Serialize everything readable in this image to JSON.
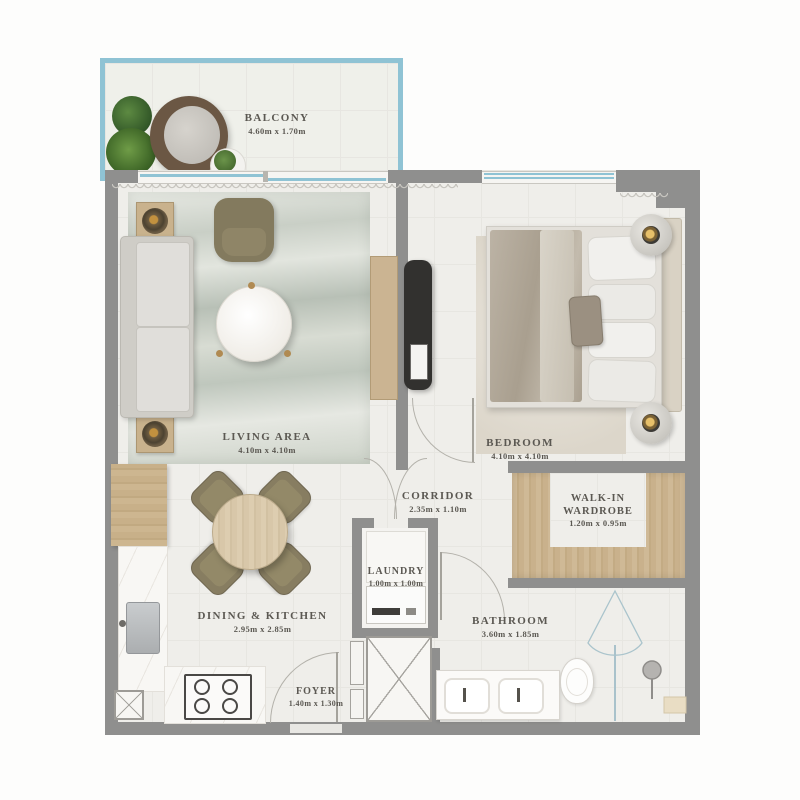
{
  "plan_type": "apartment-floor-plan",
  "rooms": {
    "balcony": {
      "name": "BALCONY",
      "dims": "4.60m x 1.70m"
    },
    "living": {
      "name": "LIVING AREA",
      "dims": "4.10m x 4.10m"
    },
    "bedroom": {
      "name": "BEDROOM",
      "dims": "4.10m x 4.10m"
    },
    "corridor": {
      "name": "CORRIDOR",
      "dims": "2.35m x 1.10m"
    },
    "wardrobe": {
      "name": "WALK-IN WARDROBE",
      "dims": "1.20m x 0.95m"
    },
    "laundry": {
      "name": "LAUNDRY",
      "dims": "1.00m x 1.00m"
    },
    "dining": {
      "name": "DINING & KITCHEN",
      "dims": "2.95m x 2.85m"
    },
    "bathroom": {
      "name": "BATHROOM",
      "dims": "3.60m x 1.85m"
    },
    "foyer": {
      "name": "FOYER",
      "dims": "1.40m x 1.30m"
    }
  },
  "colors": {
    "wall": "#8f8f8e",
    "balcony_border": "#8fc3d4",
    "window_glass": "#8fc3d4",
    "floor_tile": "#efeeea",
    "wood": "#c9b18c",
    "label_text": "#5b5852"
  }
}
